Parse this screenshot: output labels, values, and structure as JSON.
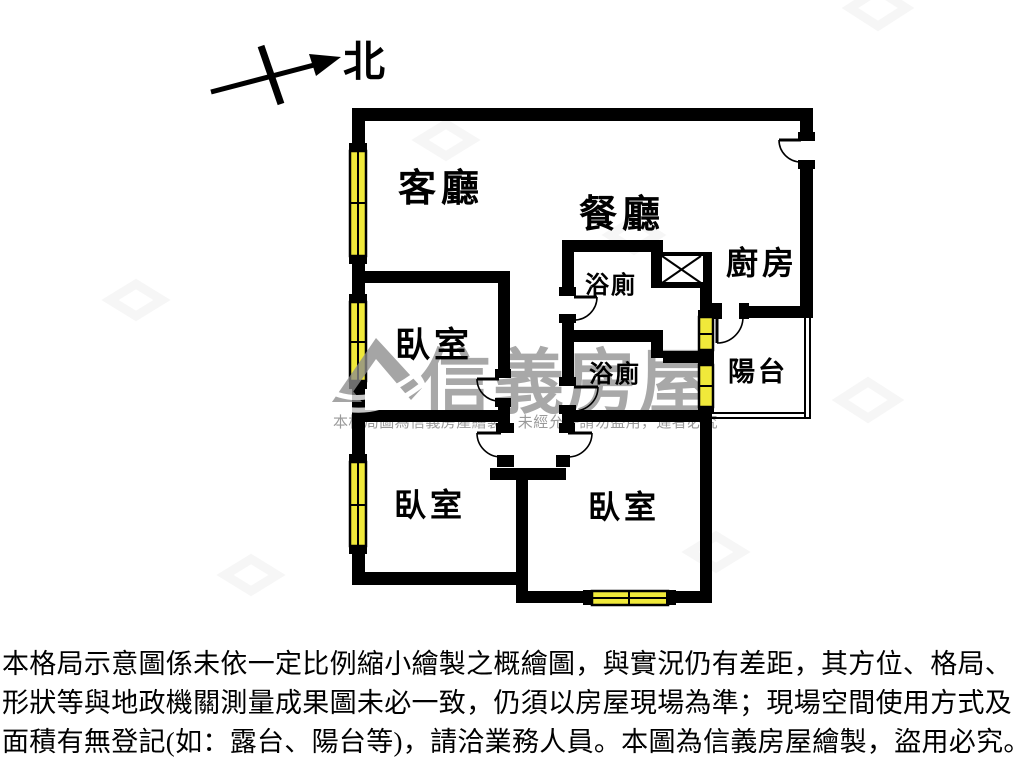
{
  "plan": {
    "north_label": "北",
    "rooms": {
      "living": "客廳",
      "dining": "餐廳",
      "kitchen": "廚房",
      "bath_upper": "浴廁",
      "bath_lower": "浴廁",
      "balcony": "陽台",
      "bedroom_mid": "臥室",
      "bedroom_bottom_left": "臥室",
      "bedroom_bottom_right": "臥室"
    }
  },
  "watermark": {
    "brand": "信義房屋",
    "notice": "本格局圖為信義房產繪製，未經允許請勿盜用，違者必究"
  },
  "disclaimer": {
    "line1": "本格局示意圖係未依一定比例縮小繪製之概繪圖，與實況仍有差距，其方位、格局、",
    "line2": "形狀等與地政機關測量成果圖未必一致，仍須以房屋現場為準；現場空間使用方式及",
    "line3": "面積有無登記(如：露台、陽台等)，請洽業務人員。本圖為信義房屋繪製，盜用必究。"
  },
  "colors": {
    "wall": "#000000",
    "window_fill": "#f0e93a",
    "watermark_gray": "#a8a8a8"
  }
}
